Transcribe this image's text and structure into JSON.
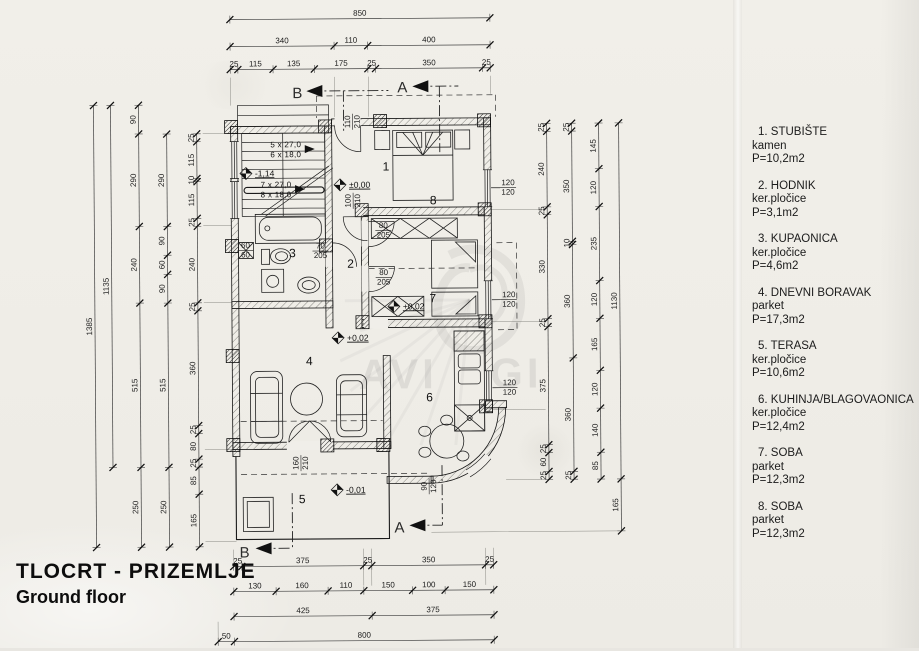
{
  "title": {
    "line1": "TLOCRT - PRIZEMLJE",
    "line2": "Ground floor"
  },
  "legend": {
    "items": [
      {
        "line1": "1. STUBIŠTE",
        "material": "kamen",
        "area": "P=10,2m2"
      },
      {
        "line1": "2. HODNIK",
        "material": "ker.pločice",
        "area": "P=3,1m2"
      },
      {
        "line1": "3. KUPAONICA",
        "material": "ker.pločice",
        "area": "P=4,6m2"
      },
      {
        "line1": "4. DNEVNI BORAVAK",
        "material": "parket",
        "area": "P=17,3m2"
      },
      {
        "line1": "5. TERASA",
        "material": "ker.pločice",
        "area": "P=10,6m2"
      },
      {
        "line1": "6. KUHINJA/BLAGOVAONICA",
        "material": "ker.pločice",
        "area": "P=12,4m2"
      },
      {
        "line1": "7. SOBA",
        "material": "parket",
        "area": "P=12,3m2"
      },
      {
        "line1": "8. SOBA",
        "material": "parket",
        "area": "P=12,3m2"
      }
    ]
  },
  "dimension_chains": [
    {
      "dir": "h",
      "x1": 232,
      "x2": 492,
      "y": 18,
      "values": [
        850
      ]
    },
    {
      "dir": "h",
      "x1": 232,
      "x2": 492,
      "y": 45,
      "values": [
        340,
        110,
        400
      ]
    },
    {
      "dir": "h",
      "x1": 232,
      "x2": 492,
      "y": 68,
      "values": [
        25,
        115,
        135,
        175,
        25,
        350,
        25
      ]
    },
    {
      "dir": "h",
      "x1": 232,
      "x2": 492,
      "y": 565,
      "values": [
        25,
        375,
        25,
        350,
        25
      ]
    },
    {
      "dir": "h",
      "x1": 232,
      "x2": 492,
      "y": 590,
      "values": [
        130,
        160,
        110,
        150,
        100,
        150
      ]
    },
    {
      "dir": "h",
      "x1": 232,
      "x2": 492,
      "y": 615,
      "values": [
        425,
        375
      ]
    },
    {
      "dir": "h",
      "x1": 216,
      "x2": 492,
      "y": 640,
      "values": [
        50,
        800
      ]
    },
    {
      "dir": "v",
      "x": 95,
      "y1": 103,
      "y2": 545,
      "values": [
        1385
      ]
    },
    {
      "dir": "v",
      "x": 112,
      "y1": 103,
      "y2": 465,
      "values": [
        1135
      ]
    },
    {
      "dir": "v",
      "x": 140,
      "y1": 103,
      "y2": 545,
      "values": [
        90,
        290,
        240,
        515,
        250
      ]
    },
    {
      "dir": "v",
      "x": 168,
      "y1": 132,
      "y2": 545,
      "values": [
        290,
        90,
        60,
        90,
        515,
        250
      ]
    },
    {
      "dir": "v",
      "x": 198,
      "y1": 132,
      "y2": 545,
      "values": [
        25,
        115,
        10,
        115,
        25,
        240,
        25,
        360,
        25,
        80,
        25,
        85,
        165
      ]
    },
    {
      "dir": "v",
      "x": 548,
      "y1": 124,
      "y2": 480,
      "values": [
        25,
        240,
        25,
        330,
        25,
        375,
        25,
        60,
        25
      ]
    },
    {
      "dir": "v",
      "x": 573,
      "y1": 124,
      "y2": 480,
      "values": [
        25,
        350,
        10,
        360,
        360,
        25
      ]
    },
    {
      "dir": "v",
      "x": 600,
      "y1": 124,
      "y2": 480,
      "values": [
        145,
        120,
        235,
        120,
        165,
        120,
        140,
        85
      ]
    },
    {
      "dir": "v",
      "x": 620,
      "y1": 124,
      "y2": 532,
      "values": [
        1130,
        165
      ]
    }
  ],
  "plan_labels": [
    {
      "x": 287,
      "y": 146,
      "text": "5 x 27,0",
      "cls": "stair",
      "name": "stair-run-label"
    },
    {
      "x": 287,
      "y": 156,
      "text": "6 x 18,0",
      "cls": "stair",
      "name": "stair-run-label"
    },
    {
      "x": 277,
      "y": 186,
      "text": "7 x 27,0",
      "cls": "stair",
      "name": "stair-run-label"
    },
    {
      "x": 277,
      "y": 196,
      "text": "8 x 18,0",
      "cls": "stair",
      "name": "stair-run-label"
    },
    {
      "x": 387,
      "y": 170,
      "text": "1",
      "cls": "room",
      "name": "room-number-1"
    },
    {
      "x": 351,
      "y": 267,
      "text": "2",
      "cls": "room",
      "name": "room-number-2"
    },
    {
      "x": 293,
      "y": 256,
      "text": "3",
      "cls": "room",
      "name": "room-number-3"
    },
    {
      "x": 309,
      "y": 364,
      "text": "4",
      "cls": "room",
      "name": "room-number-4"
    },
    {
      "x": 301,
      "y": 502,
      "text": "5",
      "cls": "room",
      "name": "room-number-5"
    },
    {
      "x": 429,
      "y": 401,
      "text": "6",
      "cls": "room",
      "name": "room-number-6"
    },
    {
      "x": 433,
      "y": 302,
      "text": "7",
      "cls": "room",
      "name": "room-number-7"
    },
    {
      "x": 434,
      "y": 204,
      "text": "8",
      "cls": "room",
      "name": "room-number-8"
    },
    {
      "x": 256,
      "y": 175,
      "text": "-1,14",
      "cls": "lvl",
      "name": "level-marker-label"
    },
    {
      "x": 350,
      "y": 187,
      "text": "±0,00",
      "cls": "lvl",
      "name": "level-marker-label"
    },
    {
      "x": 403,
      "y": 309,
      "text": "+0,02",
      "cls": "lvl",
      "name": "level-marker-label"
    },
    {
      "x": 347,
      "y": 340,
      "text": "+0,02",
      "cls": "lvl",
      "name": "level-marker-label"
    },
    {
      "x": 345,
      "y": 492,
      "text": "-0,01",
      "cls": "lvl",
      "name": "level-marker-label"
    },
    {
      "x": 509,
      "y": 188,
      "frac": [
        "120",
        "120"
      ],
      "name": "window-size-label"
    },
    {
      "x": 509,
      "y": 300,
      "frac": [
        "120",
        "120"
      ],
      "name": "window-size-label"
    },
    {
      "x": 509,
      "y": 388,
      "frac": [
        "120",
        "120"
      ],
      "name": "window-size-label"
    },
    {
      "x": 384,
      "y": 230,
      "frac": [
        "80",
        "205"
      ],
      "name": "door-size-label"
    },
    {
      "x": 384,
      "y": 277,
      "frac": [
        "80",
        "205"
      ],
      "name": "door-size-label"
    },
    {
      "x": 321,
      "y": 250,
      "frac": [
        "70",
        "205"
      ],
      "name": "door-size-label"
    },
    {
      "x": 246,
      "y": 249,
      "frac": [
        "60",
        "60"
      ],
      "name": "shaft-size-label"
    },
    {
      "x": 354,
      "y": 121,
      "frac": [
        "110",
        "210"
      ],
      "rot": -90,
      "name": "door-size-label"
    },
    {
      "x": 354,
      "y": 200,
      "frac": [
        "100",
        "210"
      ],
      "rot": -90,
      "name": "door-size-label"
    },
    {
      "x": 300,
      "y": 462,
      "frac": [
        "160",
        "210"
      ],
      "rot": -90,
      "name": "door-size-label"
    },
    {
      "x": 428,
      "y": 486,
      "frac": [
        "90",
        "120"
      ],
      "rot": -90,
      "name": "window-size-label"
    },
    {
      "x": 404,
      "y": 92,
      "text": "A",
      "cls": "sect",
      "name": "section-mark-a-top"
    },
    {
      "x": 299,
      "y": 97,
      "text": "B",
      "cls": "sect",
      "name": "section-mark-b-top"
    },
    {
      "x": 398,
      "y": 532,
      "text": "A",
      "cls": "sect",
      "name": "section-mark-a-bottom"
    },
    {
      "x": 243,
      "y": 556,
      "text": "B",
      "cls": "sect",
      "name": "section-mark-b-bottom"
    },
    {
      "x": 398,
      "y": 388,
      "text": "AVI",
      "cls": "wm",
      "name": "watermark-letters"
    },
    {
      "x": 516,
      "y": 388,
      "text": "GI",
      "cls": "wm",
      "name": "watermark-letters"
    }
  ]
}
